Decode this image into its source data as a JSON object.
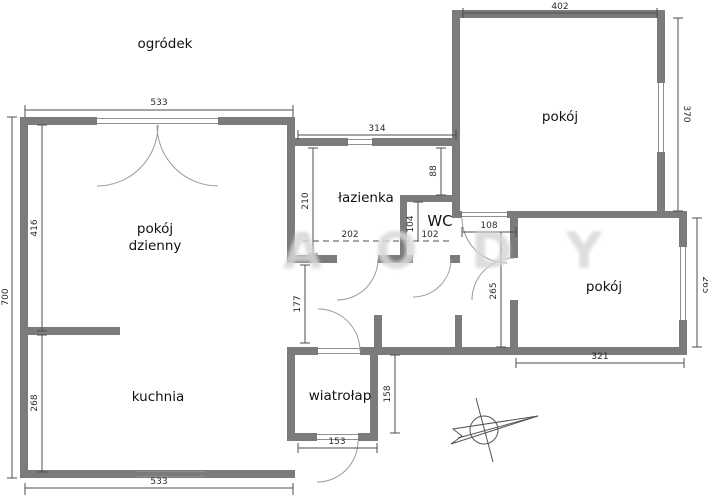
{
  "plan": {
    "garden_label": "ogródek",
    "watermark": "A O D Y"
  },
  "rooms": {
    "living_line1": "pokój",
    "living_line2": "dzienny",
    "kitchen": "kuchnia",
    "bathroom": "łazienka",
    "wc": "WC",
    "vestibule": "wiatrołap",
    "room_top": "pokój",
    "room_bottom": "pokój"
  },
  "dimensions": {
    "top_width": "533",
    "bottom_width": "533",
    "outer_height": "700",
    "living_height": "416",
    "kitchen_height": "268",
    "bathroom_top_width": "314",
    "bathroom_width": "202",
    "bathroom_height": "210",
    "bathroom_nook": "88",
    "wc_width": "102",
    "wc_height": "104",
    "room_top_width": "402",
    "room_top_height": "370",
    "room_bottom_width": "321",
    "room_bottom_height": "265",
    "hall_door": "108",
    "hall_height": "265",
    "hall_opening": "177",
    "vestibule_height": "158",
    "vestibule_width": "153"
  },
  "colors": {
    "wall": "#7b7b7b",
    "dimension_line": "#4d4d4d",
    "label_text": "#111111",
    "watermark": "#d7d7d7"
  }
}
